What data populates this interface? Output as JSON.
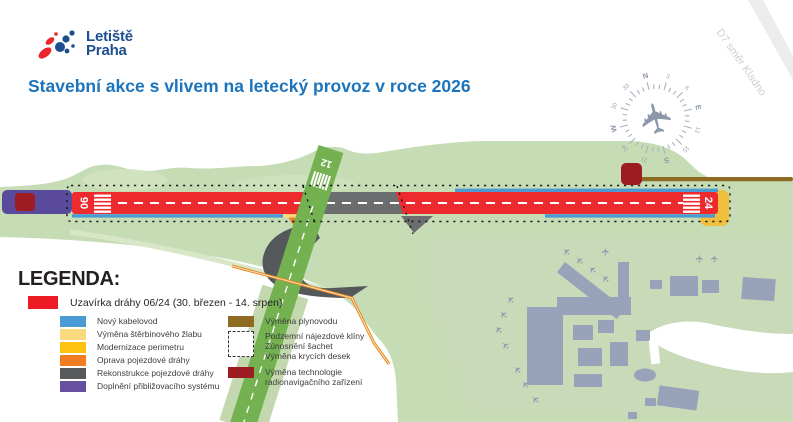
{
  "logo": {
    "line1": "Letiště",
    "line2": "Praha"
  },
  "title": "Stavební akce s vlivem na letecký provoz v roce 2026",
  "brand": {
    "title_color": "#1b74bc",
    "logo_color": "#1d4e8f",
    "logo_red": "#e8262c"
  },
  "map": {
    "road_label": "D7 směr Kladno",
    "runway_0624": {
      "left": "06",
      "right": "24"
    },
    "runway_12_label": "12",
    "compass_labels": [
      "N",
      "3",
      "6",
      "E",
      "12",
      "15",
      "S",
      "21",
      "24",
      "W",
      "30",
      "33"
    ],
    "plane_glyph": "✈",
    "colors": {
      "airfield_green": "#c6dcb4",
      "runway12_green": "#74b151",
      "closure_red": "#ed2a2e",
      "buildings_gray": "#98a2b8",
      "taxiway_dark": "#54585b"
    }
  },
  "legend": {
    "header": "LEGENDA:",
    "main": {
      "label": "Uzavírka dráhy 06/24 (30. březen - 14. srpen)",
      "color": "#ed1c24"
    },
    "col1": [
      {
        "label": "Nový kabelovod",
        "color": "#4a9bd4"
      },
      {
        "label": "Výměna štěrbinového žlabu",
        "color": "#fbd97e"
      },
      {
        "label": "Modernizace perimetru",
        "color": "#ffc20e"
      },
      {
        "label": "Oprava pojezdové dráhy",
        "color": "#f07d22"
      },
      {
        "label": "Rekonstrukce pojezdové dráhy",
        "color": "#58595b"
      },
      {
        "label": "Doplnění přibližovacího systému",
        "color": "#6850a0"
      }
    ],
    "col2": [
      {
        "label": "Výměna plynovodu",
        "color": "#8e6b22",
        "type": "solid"
      },
      {
        "lines": [
          "Podzemní nájezdové klíny",
          "Zúnosnění šachet",
          "Výměna krycích desek"
        ],
        "type": "dashed"
      },
      {
        "lines": [
          "Výměna technologie",
          "radionavigačního zařízení"
        ],
        "color": "#9c1c22",
        "type": "solid"
      }
    ]
  }
}
